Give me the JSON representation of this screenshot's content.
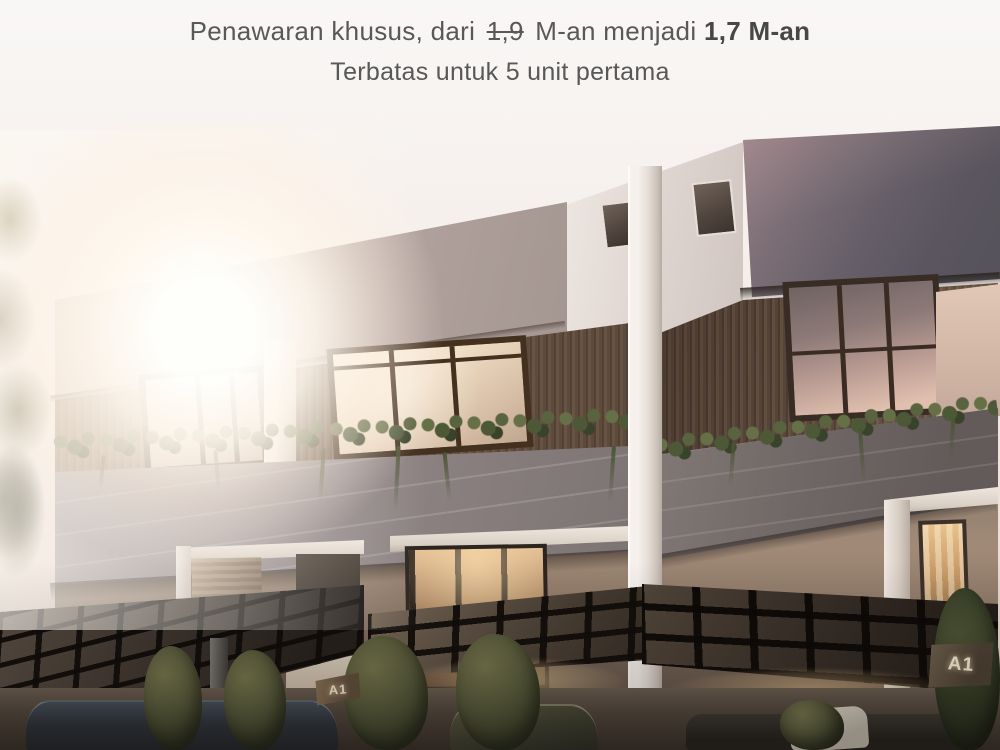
{
  "promo": {
    "line1_prefix": "Penawaran khusus, dari",
    "old_price": "1,9",
    "line1_mid": "M-an menjadi",
    "new_price": "1,7 M-an",
    "line2": "Terbatas untuk 5 unit pertama",
    "text_color": "#585858"
  },
  "units": {
    "left_plaque": "A1",
    "right_plaque": "A1"
  },
  "palette": {
    "sky": "#f6f1ee",
    "sun_glow": "#fff8ec",
    "facade_greige": "#b5a6a1",
    "facade_white": "#ece5e0",
    "facade_dark_panel": "#5e5760",
    "wood_slats": "#6b5748",
    "concrete_parapet": "#8d8384",
    "steel_canopy": "#241f1b",
    "plants_green": "#55593b",
    "warm_light": "#eec99a"
  }
}
